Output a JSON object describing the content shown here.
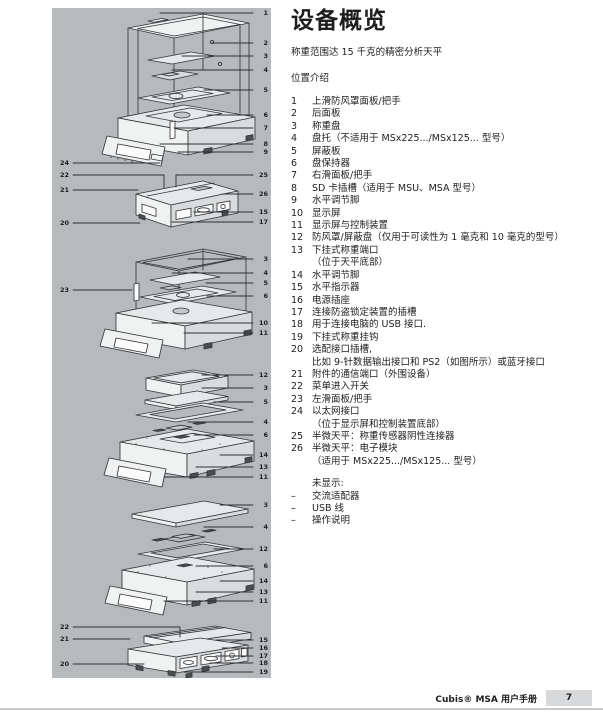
{
  "header": {
    "title": "设备概览",
    "subtitle": "称重范围达 15 千克的精密分析天平",
    "section_heading": "位置介绍"
  },
  "parts_list": [
    {
      "num": "1",
      "lines": [
        "上滑防风罩面板/把手"
      ]
    },
    {
      "num": "2",
      "lines": [
        "后面板"
      ]
    },
    {
      "num": "3",
      "lines": [
        "称重盘"
      ]
    },
    {
      "num": "4",
      "lines": [
        "盘托（不适用于 MSx225.../MSx125... 型号）"
      ]
    },
    {
      "num": "5",
      "lines": [
        "屏蔽板"
      ]
    },
    {
      "num": "6",
      "lines": [
        "盘保持器"
      ]
    },
    {
      "num": "7",
      "lines": [
        "右滑面板/把手"
      ]
    },
    {
      "num": "8",
      "lines": [
        "SD 卡插槽（适用于 MSU、MSA 型号）"
      ]
    },
    {
      "num": "9",
      "lines": [
        "水平调节脚"
      ]
    },
    {
      "num": "10",
      "lines": [
        "显示屏"
      ]
    },
    {
      "num": "11",
      "lines": [
        "显示屏与控制装置"
      ]
    },
    {
      "num": "12",
      "lines": [
        "防风罩/屏蔽盘（仅用于可读性为 1 毫克和 10 毫克的型号）"
      ]
    },
    {
      "num": "13",
      "lines": [
        "下挂式称重端口",
        "（位于天平底部）"
      ]
    },
    {
      "num": "14",
      "lines": [
        "水平调节脚"
      ]
    },
    {
      "num": "15",
      "lines": [
        "水平指示器"
      ]
    },
    {
      "num": "16",
      "lines": [
        "电源插座"
      ]
    },
    {
      "num": "17",
      "lines": [
        "连接防盗锁定装置的插槽"
      ]
    },
    {
      "num": "18",
      "lines": [
        "用于连接电脑的 USB 接口."
      ]
    },
    {
      "num": "19",
      "lines": [
        "下挂式称重挂钩"
      ]
    },
    {
      "num": "20",
      "lines": [
        "选配接口插槽,",
        "比如 9-针数据输出接口和 PS2（如图所示）或蓝牙接口"
      ]
    },
    {
      "num": "21",
      "lines": [
        "附件的通信端口（外围设备）"
      ]
    },
    {
      "num": "22",
      "lines": [
        "菜单进入开关"
      ]
    },
    {
      "num": "23",
      "lines": [
        "左滑面板/把手"
      ]
    },
    {
      "num": "24",
      "lines": [
        "以太网接口",
        "（位于显示屏和控制装置底部）"
      ]
    },
    {
      "num": "25",
      "lines": [
        "半微天平：称重传感器阴性连接器"
      ]
    },
    {
      "num": "26",
      "lines": [
        "半微天平：电子模块",
        "（适用于 MSx225.../MSx125... 型号）"
      ]
    }
  ],
  "not_shown": {
    "heading": "未显示:",
    "bullet": "–",
    "items": [
      "交流适配器",
      "USB 线",
      "操作说明"
    ]
  },
  "footer": {
    "manual_title": "Cubis® MSA 用户手册",
    "page_number": "7"
  },
  "diagram": {
    "panel_bg": "#b7babd",
    "callouts": [
      {
        "n": "1",
        "side": "right",
        "y": 5,
        "x1": 108
      },
      {
        "n": "2",
        "side": "right",
        "y": 35,
        "x1": 160
      },
      {
        "n": "3",
        "side": "right",
        "y": 48,
        "x1": 130
      },
      {
        "n": "4",
        "side": "right",
        "y": 62,
        "x1": 120
      },
      {
        "n": "5",
        "side": "right",
        "y": 82,
        "x1": 152
      },
      {
        "n": "6",
        "side": "right",
        "y": 107,
        "x1": 155
      },
      {
        "n": "7",
        "side": "right",
        "y": 120,
        "x1": 122
      },
      {
        "n": "8",
        "side": "right",
        "y": 136,
        "x1": 108
      },
      {
        "n": "9",
        "side": "right",
        "y": 144,
        "x1": 126
      },
      {
        "n": "24",
        "side": "left",
        "y": 155,
        "x2": 108
      },
      {
        "n": "22",
        "side": "left",
        "y": 167,
        "x2": 112,
        "drop": 13
      },
      {
        "n": "25",
        "side": "right",
        "y": 167,
        "x1": 124,
        "drop": 12
      },
      {
        "n": "21",
        "side": "left",
        "y": 182,
        "x2": 86
      },
      {
        "n": "26",
        "side": "right",
        "y": 186,
        "x1": 170
      },
      {
        "n": "15",
        "side": "right",
        "y": 204,
        "x1": 142
      },
      {
        "n": "20",
        "side": "left",
        "y": 215,
        "x2": 88
      },
      {
        "n": "17",
        "side": "right",
        "y": 214,
        "x1": 120
      },
      {
        "n": "3",
        "side": "right",
        "y": 251,
        "x1": 136
      },
      {
        "n": "4",
        "side": "right",
        "y": 265,
        "x1": 120
      },
      {
        "n": "5",
        "side": "right",
        "y": 275,
        "x1": 154
      },
      {
        "n": "23",
        "side": "left",
        "y": 282,
        "x2": 80
      },
      {
        "n": "6",
        "side": "right",
        "y": 288,
        "x1": 155
      },
      {
        "n": "10",
        "side": "right",
        "y": 315,
        "x1": 100
      },
      {
        "n": "11",
        "side": "right",
        "y": 325,
        "x1": 132
      },
      {
        "n": "12",
        "side": "right",
        "y": 367,
        "x1": 150
      },
      {
        "n": "3",
        "side": "right",
        "y": 380,
        "x1": 150
      },
      {
        "n": "5",
        "side": "right",
        "y": 394,
        "x1": 162
      },
      {
        "n": "4",
        "side": "right",
        "y": 414,
        "x1": 136
      },
      {
        "n": "6",
        "side": "right",
        "y": 427,
        "x1": 142
      },
      {
        "n": "14",
        "side": "right",
        "y": 447,
        "x1": 168
      },
      {
        "n": "13",
        "side": "right",
        "y": 459,
        "x1": 144
      },
      {
        "n": "11",
        "side": "right",
        "y": 469,
        "x1": 112
      },
      {
        "n": "3",
        "side": "right",
        "y": 497,
        "x1": 168
      },
      {
        "n": "4",
        "side": "right",
        "y": 519,
        "x1": 152
      },
      {
        "n": "12",
        "side": "right",
        "y": 541,
        "x1": 162
      },
      {
        "n": "6",
        "side": "right",
        "y": 558,
        "x1": 144
      },
      {
        "n": "14",
        "side": "right",
        "y": 573,
        "x1": 168
      },
      {
        "n": "13",
        "side": "right",
        "y": 584,
        "x1": 144
      },
      {
        "n": "11",
        "side": "right",
        "y": 593,
        "x1": 112
      },
      {
        "n": "22",
        "side": "left",
        "y": 619,
        "x2": 128,
        "drop": 10
      },
      {
        "n": "21",
        "side": "left",
        "y": 631,
        "x2": 78
      },
      {
        "n": "15",
        "side": "right",
        "y": 632,
        "x1": 164
      },
      {
        "n": "16",
        "side": "right",
        "y": 640,
        "x1": 170
      },
      {
        "n": "17",
        "side": "right",
        "y": 648,
        "x1": 164
      },
      {
        "n": "18",
        "side": "right",
        "y": 655,
        "x1": 158
      },
      {
        "n": "20",
        "side": "left",
        "y": 656,
        "x2": 92
      },
      {
        "n": "19",
        "side": "right",
        "y": 664,
        "x1": 132
      }
    ]
  }
}
